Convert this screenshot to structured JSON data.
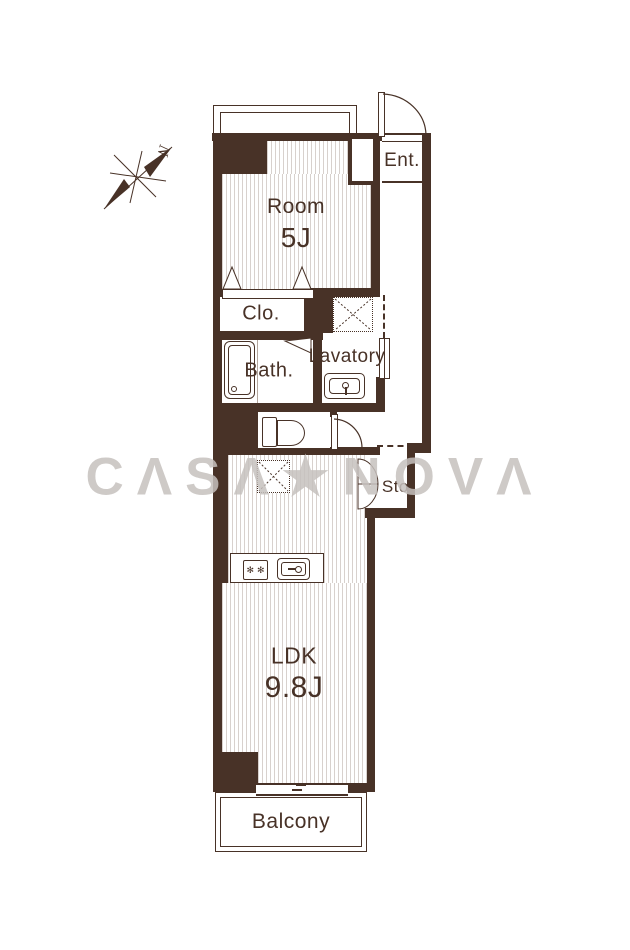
{
  "title": "apartment-floor-plan",
  "colors": {
    "wall": "#483227",
    "stripe": "#d8d1cd",
    "watermark": "#c6c1be",
    "bg": "#ffffff"
  },
  "compass": {
    "label": "N"
  },
  "watermark": {
    "text": "CΛSΛ★NOVΛ"
  },
  "icons": {
    "burner_glyph": "✻"
  },
  "rooms": {
    "room": {
      "name": "Room",
      "size": "5J"
    },
    "entrance": {
      "label": "Ent."
    },
    "closet": {
      "label": "Clo."
    },
    "bath": {
      "label": "Bath."
    },
    "lavatory": {
      "label": "Lavatory"
    },
    "storage": {
      "label": "Sto."
    },
    "ldk": {
      "name": "LDK",
      "size": "9.8J"
    },
    "balcony": {
      "label": "Balcony"
    }
  }
}
